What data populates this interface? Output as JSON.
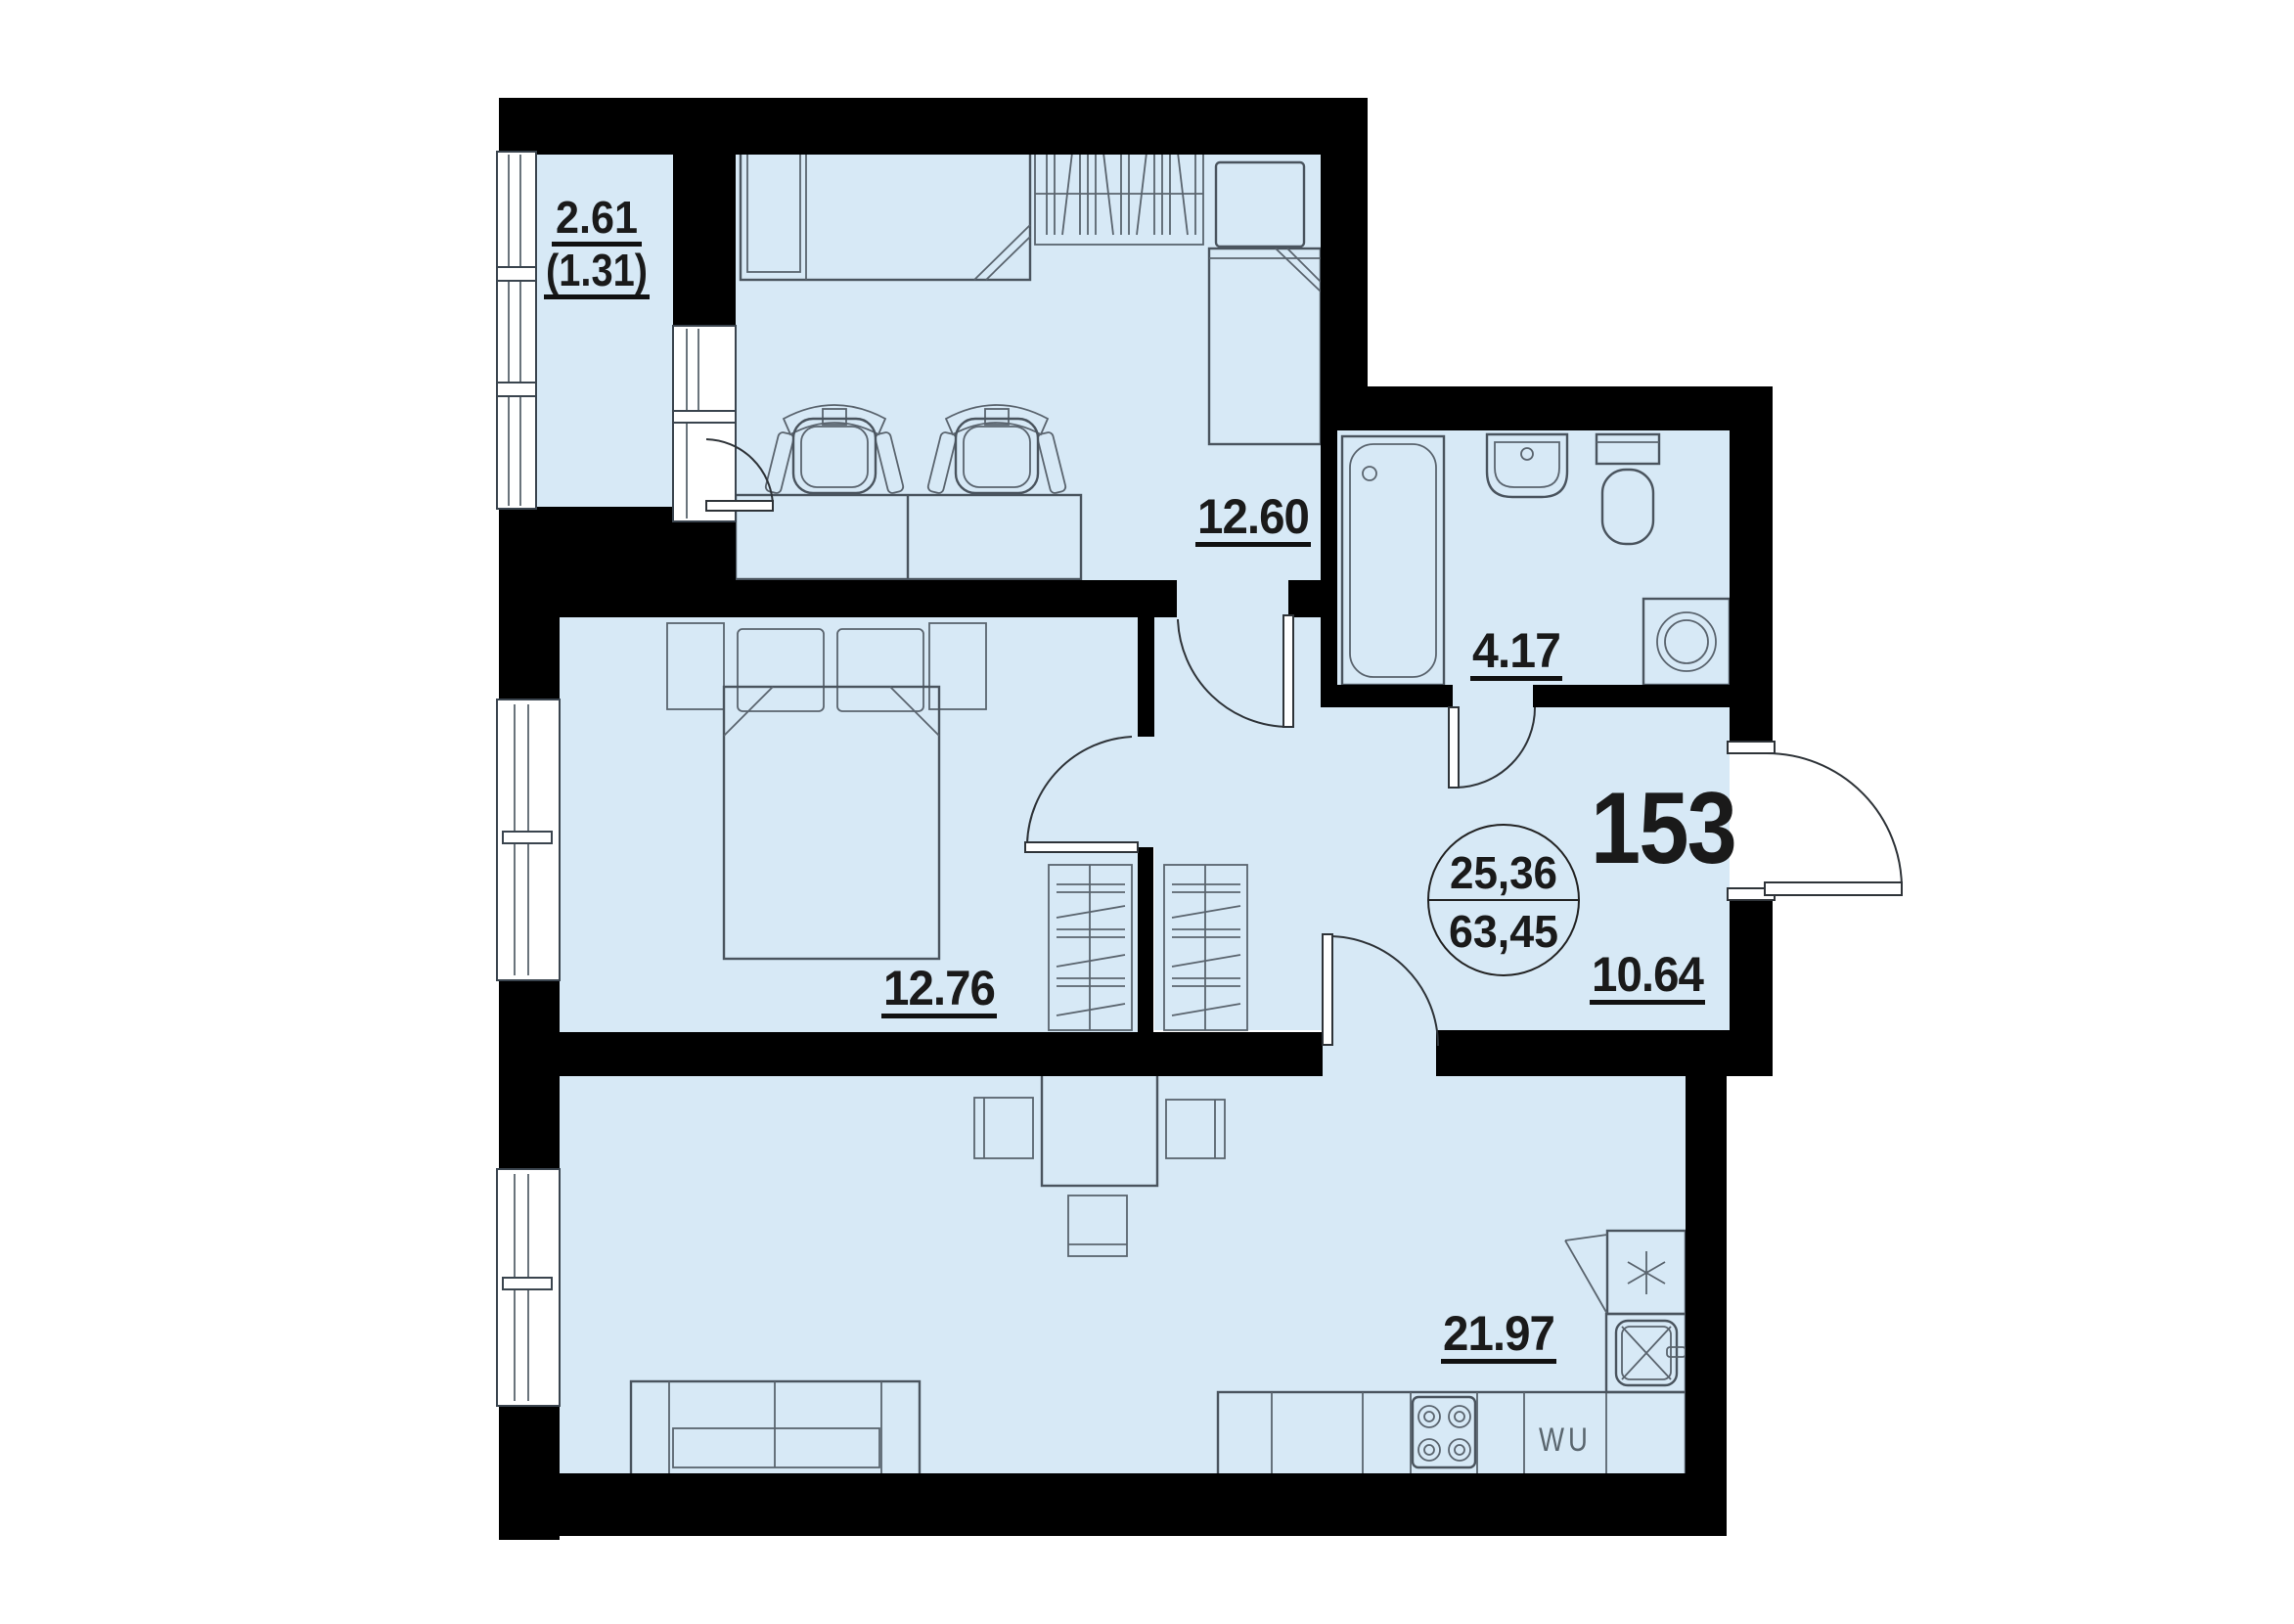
{
  "plan": {
    "unit_number": "153",
    "area_summary": {
      "living_area": "25,36",
      "total_area": "63,45"
    },
    "rooms": [
      {
        "name": "balcony",
        "area": "2.61",
        "area_note": "(1.31)"
      },
      {
        "name": "children-room",
        "area": "12.60"
      },
      {
        "name": "bathroom",
        "area": "4.17"
      },
      {
        "name": "bedroom",
        "area": "12.76"
      },
      {
        "name": "hallway",
        "area": "10.64"
      },
      {
        "name": "living-kitchen",
        "area": "21.97"
      }
    ],
    "appliance_labels": {
      "dishwasher": "WU"
    },
    "colors": {
      "floor": "#d7e9f6",
      "wall": "#000000",
      "furniture_line": "#4a545e",
      "text": "#1a1a1a"
    }
  }
}
